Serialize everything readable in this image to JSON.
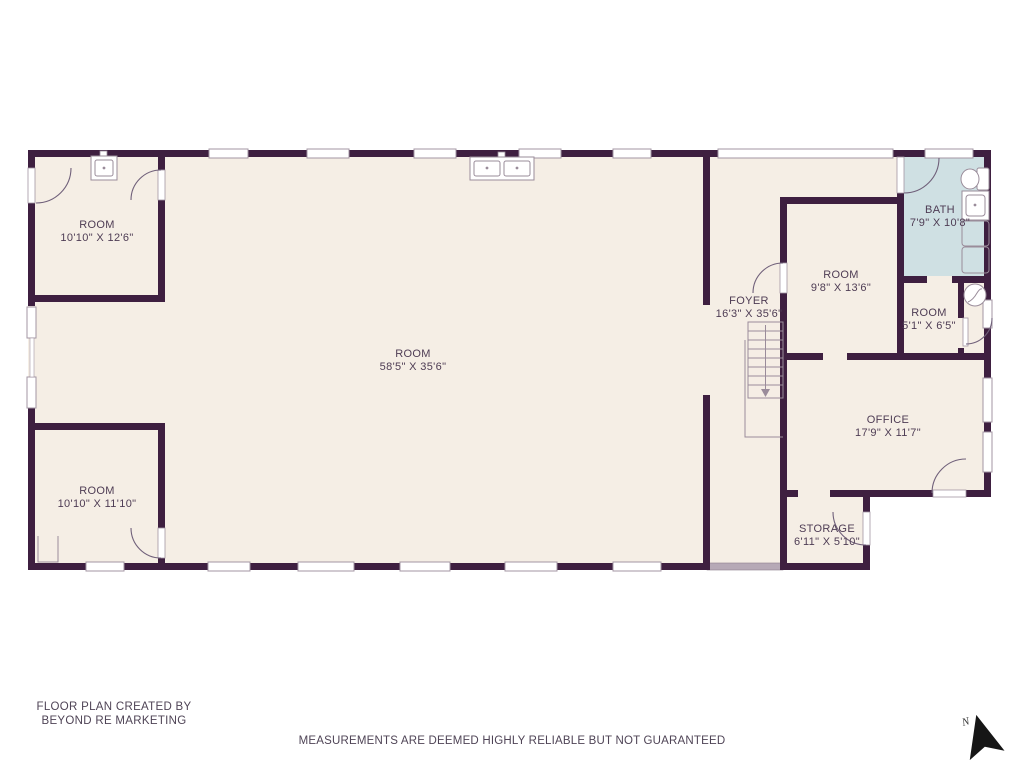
{
  "plan": {
    "rooms": [
      {
        "id": "room-top-left",
        "name": "ROOM",
        "dims": "10'10\" X 12'6\""
      },
      {
        "id": "room-main",
        "name": "ROOM",
        "dims": "58'5\" X 35'6\""
      },
      {
        "id": "room-bottom-left",
        "name": "ROOM",
        "dims": "10'10\" X 11'10\""
      },
      {
        "id": "foyer",
        "name": "FOYER",
        "dims": "16'3\" X 35'6\""
      },
      {
        "id": "room-middle-right",
        "name": "ROOM",
        "dims": "9'8\" X 13'6\""
      },
      {
        "id": "bath",
        "name": "BATH",
        "dims": "7'9\" X 10'8\""
      },
      {
        "id": "room-small-right",
        "name": "ROOM",
        "dims": "5'1\" X 6'5\""
      },
      {
        "id": "office",
        "name": "OFFICE",
        "dims": "17'9\" X 11'7\""
      },
      {
        "id": "storage",
        "name": "STORAGE",
        "dims": "6'11\" X 5'10\""
      }
    ],
    "compass_label": "N"
  },
  "footer": {
    "credit_line1": "FLOOR PLAN CREATED BY",
    "credit_line2": "BEYOND RE MARKETING",
    "disclaimer": "MEASUREMENTS ARE DEEMED HIGHLY RELIABLE BUT NOT GUARANTEED"
  },
  "colors": {
    "wall": "#3e1f40",
    "floor": "#f5eee5",
    "bath_floor": "#cfe0e3",
    "entry_door": "#b6a9b6",
    "label_text": "#4e3c54",
    "footer_text": "#4f4456"
  }
}
